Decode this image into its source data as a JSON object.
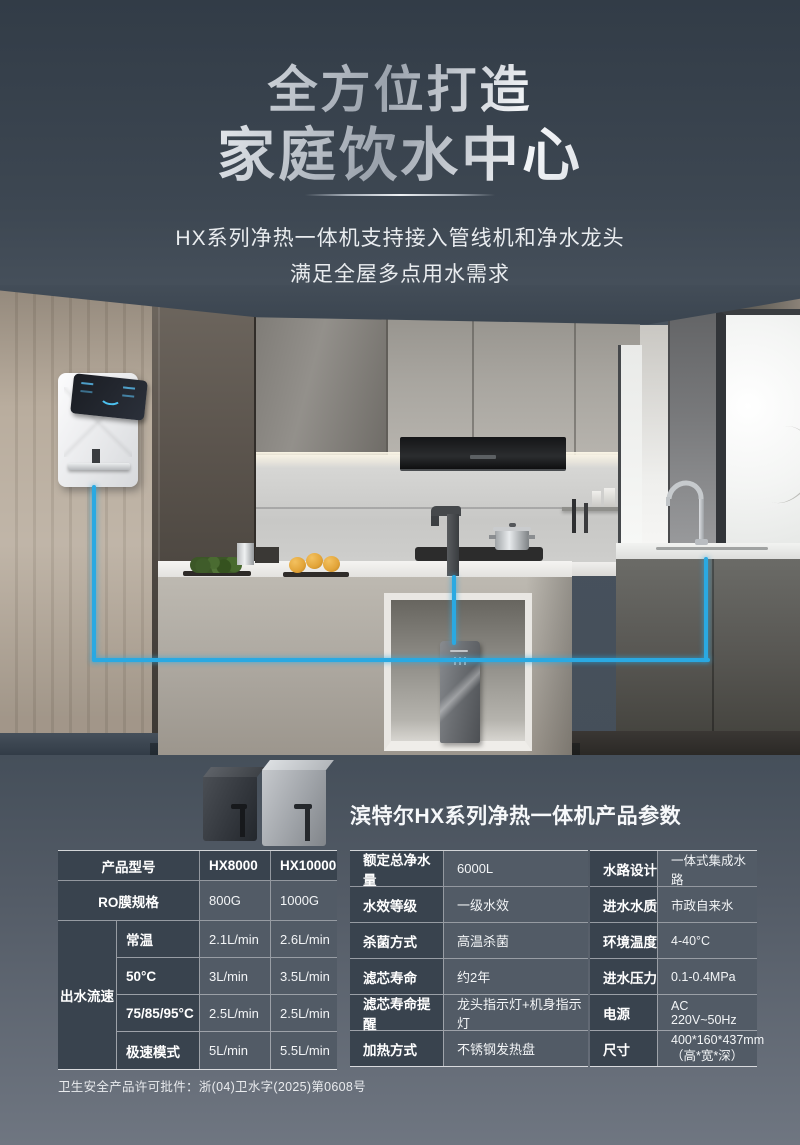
{
  "hero": {
    "title_line1": "全方位打造",
    "title_line2": "家庭饮水中心",
    "subtitle_line1": "HX系列净热一体机支持接入管线机和净水龙头",
    "subtitle_line2": "满足全屋多点用水需求"
  },
  "products": {
    "section_title": "滨特尔HX系列净热一体机产品参数"
  },
  "tables": {
    "left": {
      "header": [
        "产品型号",
        "HX8000",
        "HX10000"
      ],
      "rows": [
        {
          "label": "RO膜规格",
          "v1": "800G",
          "v2": "1000G"
        }
      ],
      "flow": {
        "group_label": "出水流速",
        "rows": [
          {
            "label": "常温",
            "v1": "2.1L/min",
            "v2": "2.6L/min"
          },
          {
            "label": "50°C",
            "v1": "3L/min",
            "v2": "3.5L/min"
          },
          {
            "label": "75/85/95°C",
            "v1": "2.5L/min",
            "v2": "2.5L/min"
          },
          {
            "label": "极速模式",
            "v1": "5L/min",
            "v2": "5.5L/min"
          }
        ]
      }
    },
    "middle": {
      "rows": [
        {
          "label": "额定总净水量",
          "value": "6000L"
        },
        {
          "label": "水效等级",
          "value": "一级水效"
        },
        {
          "label": "杀菌方式",
          "value": "高温杀菌"
        },
        {
          "label": "滤芯寿命",
          "value": "约2年"
        },
        {
          "label": "滤芯寿命提醒",
          "value": "龙头指示灯+机身指示灯"
        },
        {
          "label": "加热方式",
          "value": "不锈钢发热盘"
        }
      ]
    },
    "right": {
      "rows": [
        {
          "label": "水路设计",
          "value": "一体式集成水路"
        },
        {
          "label": "进水水质",
          "value": "市政自来水"
        },
        {
          "label": "环境温度",
          "value": "4-40°C"
        },
        {
          "label": "进水压力",
          "value": "0.1-0.4MPa"
        },
        {
          "label": "电源",
          "value": "AC 220V~50Hz"
        },
        {
          "label": "尺寸",
          "value": "400*160*437mm\n（高*宽*深）"
        }
      ]
    }
  },
  "footer": {
    "license": "卫生安全产品许可批件：浙(04)卫水字(2025)第0608号"
  },
  "colors": {
    "accent_blue": "#2AA9E2",
    "table_label_bg": "#39434E",
    "table_value_bg": "#525B66",
    "page_top_bg": "#323C47",
    "page_bottom_bg": "#6F7681"
  }
}
